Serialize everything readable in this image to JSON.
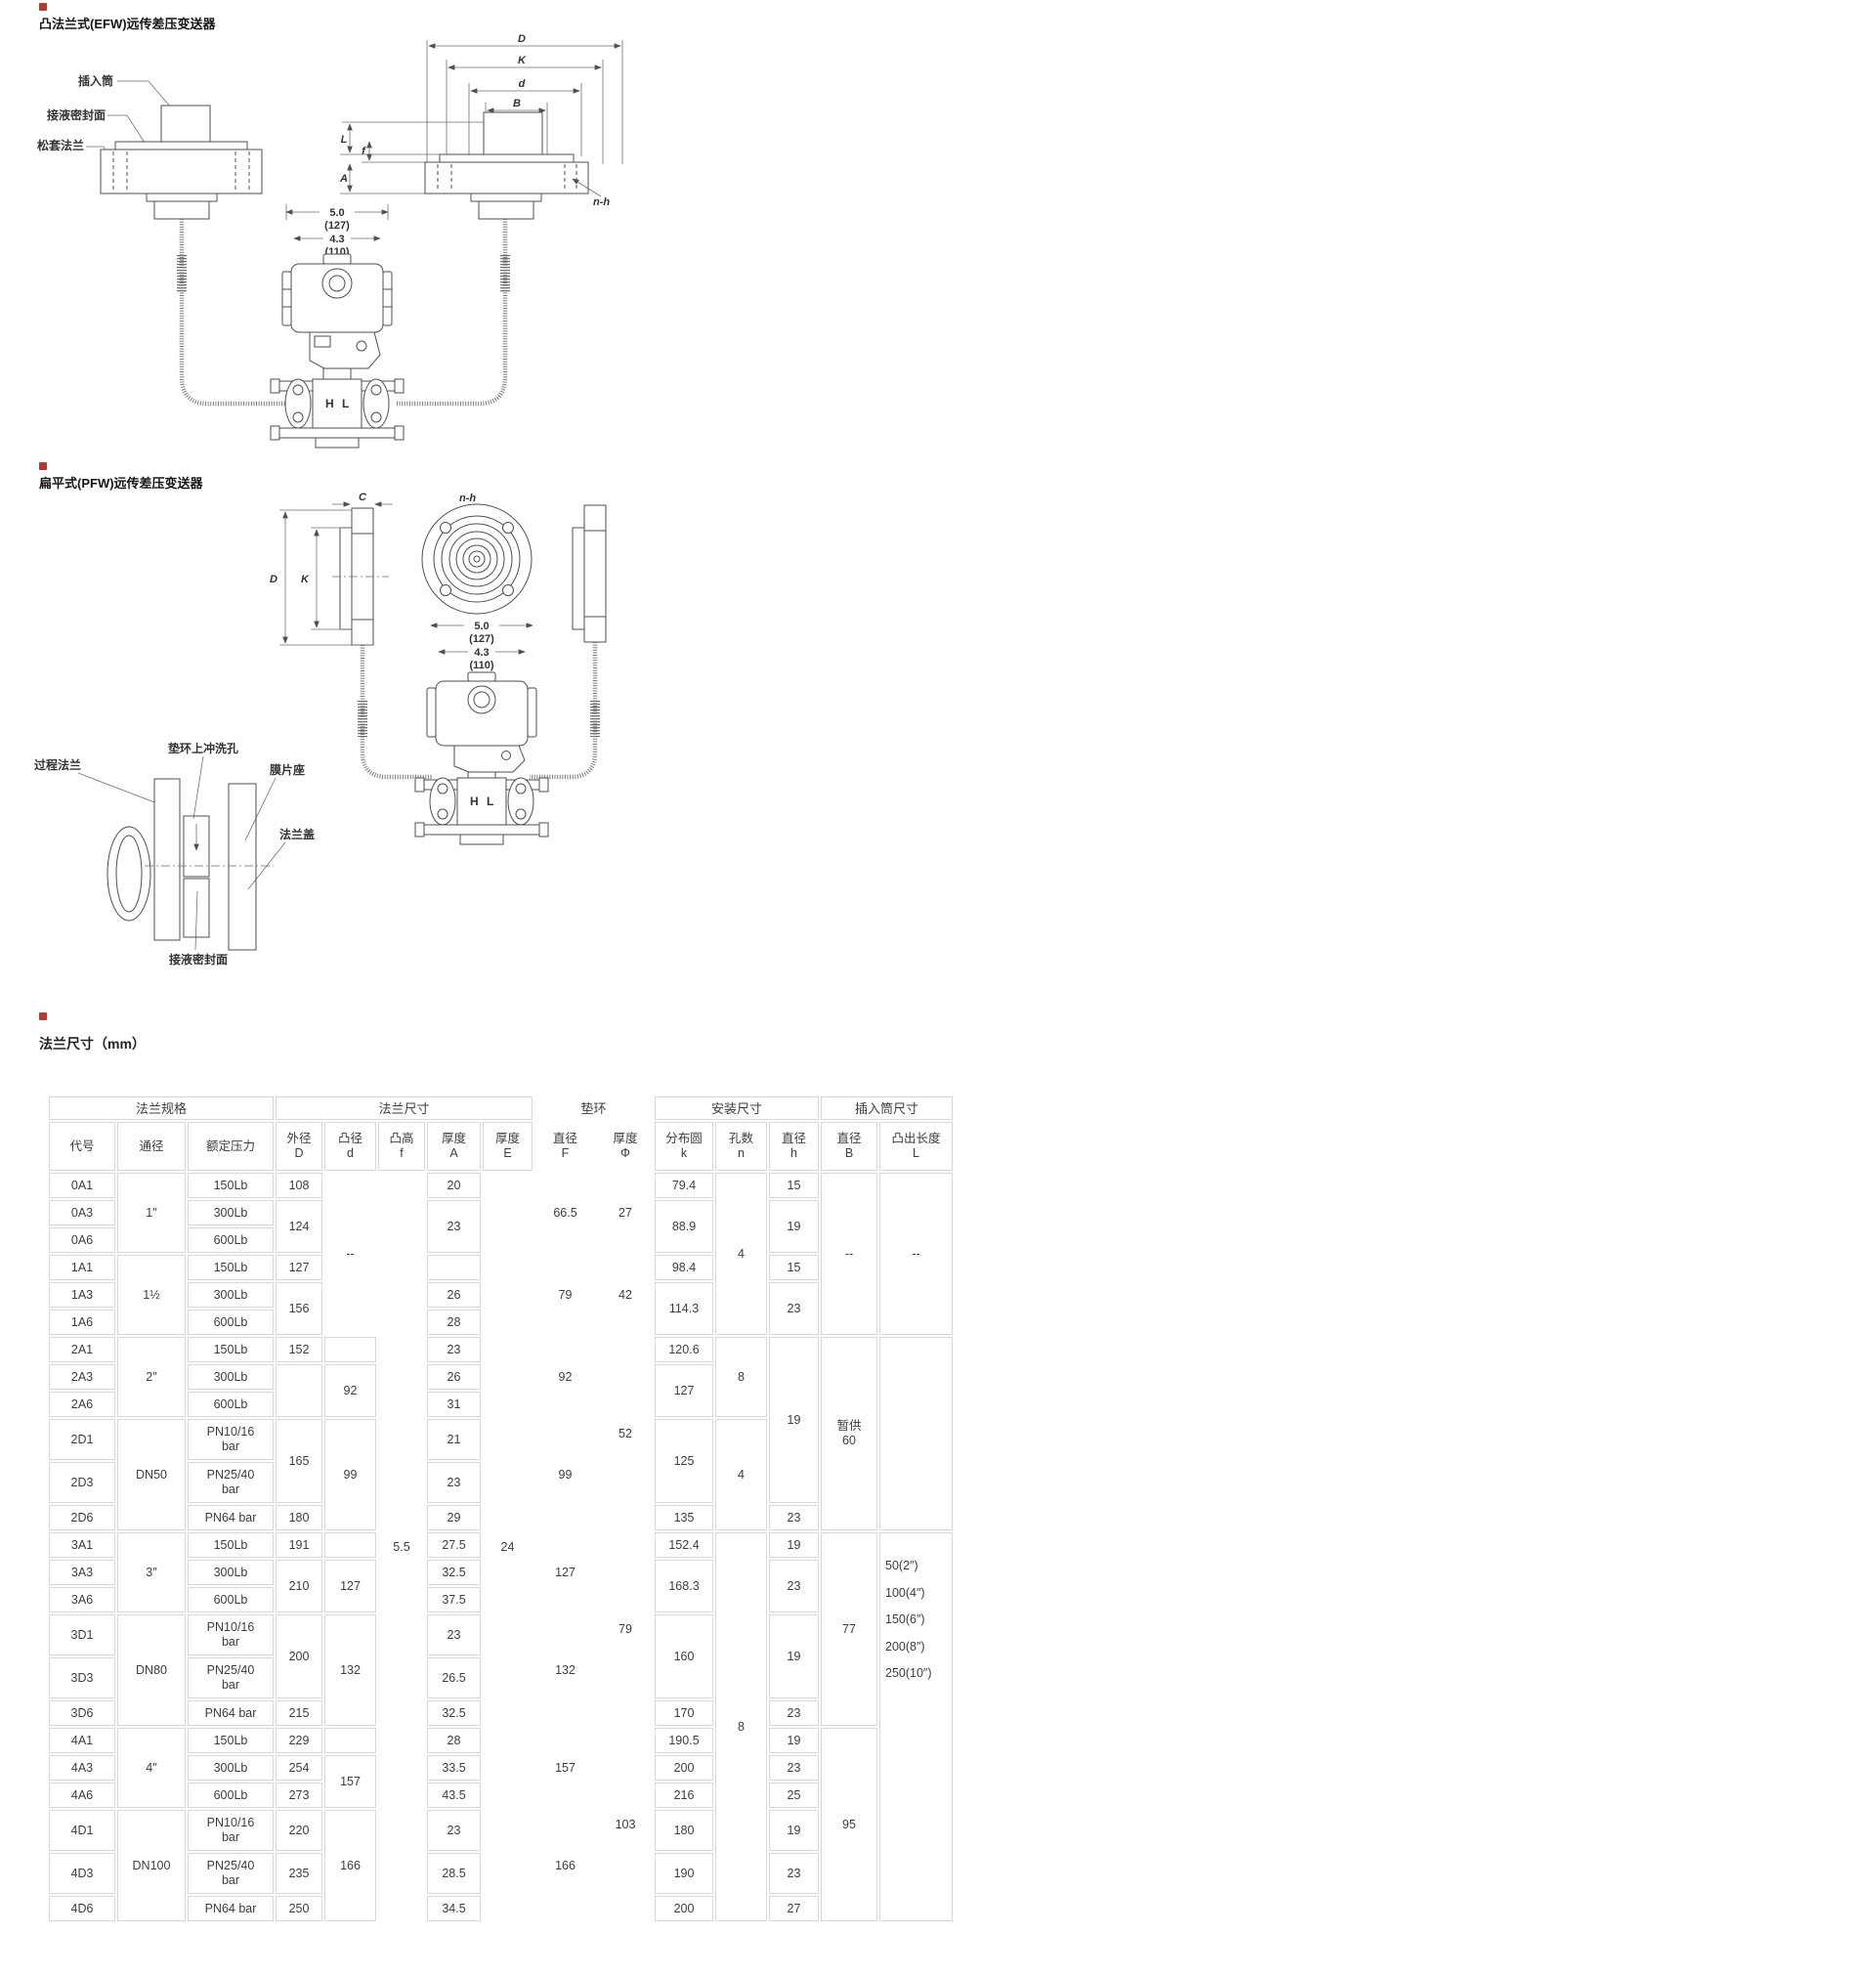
{
  "colors": {
    "bullet": "#b23b2e",
    "table_border": "#d8d8d8",
    "text": "#3d3d3d",
    "line": "#4f4f4f"
  },
  "efw": {
    "title": "凸法兰式(EFW)远传差压变送器",
    "labels": {
      "insert_tube": "插入筒",
      "wetted_seal_face": "接液密封面",
      "loose_flange": "松套法兰",
      "dim_D": "D",
      "dim_K": "K",
      "dim_d": "d",
      "dim_B": "B",
      "dim_L": "L",
      "dim_A": "A",
      "dim_f": "f",
      "n_h": "n-h",
      "width_in": "5.0",
      "width_mm": "(127)",
      "width2_in": "4.3",
      "width2_mm": "(110)",
      "port_H": "H",
      "port_L": "L"
    }
  },
  "pfw": {
    "title": "扁平式(PFW)远传差压变送器",
    "labels": {
      "process_flange": "过程法兰",
      "flush_hole": "垫环上冲洗孔",
      "diaphragm_seat": "膜片座",
      "flange_cover": "法兰盖",
      "wetted_seal_face": "接液密封面",
      "dim_C": "C",
      "dim_D": "D",
      "dim_K": "K",
      "n_h": "n-h",
      "width_in": "5.0",
      "width_mm": "(127)",
      "width2_in": "4.3",
      "width2_mm": "(110)",
      "port_H": "H",
      "port_L": "L"
    }
  },
  "table": {
    "title": "法兰尺寸（mm）",
    "groups": [
      {
        "label": "法兰规格",
        "span": 3,
        "bordered": true
      },
      {
        "label": "法兰尺寸",
        "span": 5,
        "bordered": true
      },
      {
        "label": "垫环",
        "span": 2,
        "bordered": false
      },
      {
        "label": "安装尺寸",
        "span": 3,
        "bordered": true
      },
      {
        "label": "插入筒尺寸",
        "span": 2,
        "bordered": true
      }
    ],
    "columns": [
      {
        "label": "代号",
        "width": 68
      },
      {
        "label": "通径",
        "width": 70
      },
      {
        "label": "额定压力",
        "width": 88
      },
      {
        "label": "外径\nD",
        "width": 48
      },
      {
        "label": "凸径\nd",
        "width": 53
      },
      {
        "label": "凸高\nf",
        "width": 48
      },
      {
        "label": "厚度\nA",
        "width": 55
      },
      {
        "label": "厚度\nE",
        "width": 51
      },
      {
        "label": "直径\nF",
        "width": 63,
        "borderless": true
      },
      {
        "label": "厚度\nΦ",
        "width": 56,
        "borderless": true
      },
      {
        "label": "分布圆\nk",
        "width": 60
      },
      {
        "label": "孔数\nn",
        "width": 53
      },
      {
        "label": "直径\nh",
        "width": 51
      },
      {
        "label": "直径\nB",
        "width": 58
      },
      {
        "label": "凸出长度\nL",
        "width": 75
      }
    ],
    "rows": [
      {
        "cells": [
          {
            "t": "0A1"
          },
          {
            "t": "1″",
            "rs": 3
          },
          {
            "t": "150Lb"
          },
          {
            "t": "108"
          },
          {
            "t": "--",
            "rs": 6,
            "nb": true
          },
          {
            "t": "5.5",
            "rs": 24,
            "nb": true
          },
          {
            "t": "20"
          },
          {
            "t": "24",
            "rs": 24,
            "nb": true
          },
          {
            "t": "66.5",
            "rs": 3,
            "nb": true
          },
          {
            "t": "27",
            "rs": 3,
            "nb": true
          },
          {
            "t": "79.4"
          },
          {
            "t": "4",
            "rs": 6
          },
          {
            "t": "15"
          },
          {
            "t": "--",
            "rs": 6
          },
          {
            "t": "--",
            "rs": 6
          }
        ]
      },
      {
        "cells": [
          {
            "t": "0A3"
          },
          {
            "t": "300Lb"
          },
          {
            "t": "124",
            "rs": 2
          },
          {
            "t": "23",
            "rs": 2
          },
          {
            "t": "88.9",
            "rs": 2
          },
          {
            "t": "19",
            "rs": 2
          }
        ]
      },
      {
        "cells": [
          {
            "t": "0A6"
          },
          {
            "t": "600Lb"
          }
        ]
      },
      {
        "cells": [
          {
            "t": "1A1"
          },
          {
            "t": "1½",
            "rs": 3
          },
          {
            "t": "150Lb"
          },
          {
            "t": "127"
          },
          {
            "t": ""
          },
          {
            "t": "79",
            "rs": 3,
            "nb": true
          },
          {
            "t": "42",
            "rs": 3,
            "nb": true
          },
          {
            "t": "98.4"
          },
          {
            "t": "15"
          }
        ]
      },
      {
        "cells": [
          {
            "t": "1A3"
          },
          {
            "t": "300Lb"
          },
          {
            "t": "156",
            "rs": 2
          },
          {
            "t": "26"
          },
          {
            "t": "114.3",
            "rs": 2
          },
          {
            "t": "23",
            "rs": 2
          }
        ]
      },
      {
        "cells": [
          {
            "t": "1A6"
          },
          {
            "t": "600Lb"
          },
          {
            "t": "28"
          }
        ]
      },
      {
        "cells": [
          {
            "t": "2A1"
          },
          {
            "t": "2″",
            "rs": 3
          },
          {
            "t": "150Lb"
          },
          {
            "t": "152"
          },
          {
            "t": ""
          },
          {
            "t": "23"
          },
          {
            "t": "92",
            "rs": 3,
            "nb": true
          },
          {
            "t": "52",
            "rs": 6,
            "nb": true
          },
          {
            "t": "120.6"
          },
          {
            "t": "8",
            "rs": 3
          },
          {
            "t": "19",
            "rs": 5
          },
          {
            "t": "暂供\n60",
            "rs": 6
          },
          {
            "t": "",
            "rs": 6
          }
        ]
      },
      {
        "cells": [
          {
            "t": "2A3"
          },
          {
            "t": "300Lb"
          },
          {
            "t": "",
            "rs": 2
          },
          {
            "t": "92",
            "rs": 2
          },
          {
            "t": "26"
          },
          {
            "t": "127",
            "rs": 2
          }
        ]
      },
      {
        "cells": [
          {
            "t": "2A6"
          },
          {
            "t": "600Lb"
          },
          {
            "t": "31"
          }
        ]
      },
      {
        "tall": true,
        "cells": [
          {
            "t": "2D1"
          },
          {
            "t": "DN50",
            "rs": 3
          },
          {
            "t": "PN10/16\nbar"
          },
          {
            "t": "165",
            "rs": 2
          },
          {
            "t": "99",
            "rs": 3
          },
          {
            "t": "21"
          },
          {
            "t": "99",
            "rs": 3,
            "nb": true
          },
          {
            "t": "125",
            "rs": 2
          },
          {
            "t": "4",
            "rs": 3
          }
        ]
      },
      {
        "tall": true,
        "cells": [
          {
            "t": "2D3"
          },
          {
            "t": "PN25/40\nbar"
          },
          {
            "t": "23"
          }
        ]
      },
      {
        "cells": [
          {
            "t": "2D6"
          },
          {
            "t": "PN64 bar"
          },
          {
            "t": "180"
          },
          {
            "t": "29"
          },
          {
            "t": "135"
          },
          {
            "t": "23"
          }
        ]
      },
      {
        "cells": [
          {
            "t": "3A1"
          },
          {
            "t": "3″",
            "rs": 3
          },
          {
            "t": "150Lb"
          },
          {
            "t": "191"
          },
          {
            "t": ""
          },
          {
            "t": "27.5"
          },
          {
            "t": "127",
            "rs": 3,
            "nb": true
          },
          {
            "t": "79",
            "rs": 6,
            "nb": true
          },
          {
            "t": "152.4"
          },
          {
            "t": "8",
            "rs": 12
          },
          {
            "t": "19"
          },
          {
            "t": "77",
            "rs": 6
          },
          {
            "t": "50(2″)\n100(4″)\n150(6″)\n200(8″)\n250(10″)",
            "rs": 12,
            "cls": "l-list"
          }
        ]
      },
      {
        "cells": [
          {
            "t": "3A3"
          },
          {
            "t": "300Lb"
          },
          {
            "t": "210",
            "rs": 2
          },
          {
            "t": "127",
            "rs": 2
          },
          {
            "t": "32.5"
          },
          {
            "t": "168.3",
            "rs": 2
          },
          {
            "t": "23",
            "rs": 2
          }
        ]
      },
      {
        "cells": [
          {
            "t": "3A6"
          },
          {
            "t": "600Lb"
          },
          {
            "t": "37.5"
          }
        ]
      },
      {
        "tall": true,
        "cells": [
          {
            "t": "3D1"
          },
          {
            "t": "DN80",
            "rs": 3
          },
          {
            "t": "PN10/16\nbar"
          },
          {
            "t": "200",
            "rs": 2
          },
          {
            "t": "132",
            "rs": 3
          },
          {
            "t": "23"
          },
          {
            "t": "132",
            "rs": 3,
            "nb": true
          },
          {
            "t": "160",
            "rs": 2
          },
          {
            "t": "19",
            "rs": 2
          }
        ]
      },
      {
        "tall": true,
        "cells": [
          {
            "t": "3D3"
          },
          {
            "t": "PN25/40\nbar"
          },
          {
            "t": "26.5"
          }
        ]
      },
      {
        "cells": [
          {
            "t": "3D6"
          },
          {
            "t": "PN64 bar"
          },
          {
            "t": "215"
          },
          {
            "t": "32.5"
          },
          {
            "t": "170"
          },
          {
            "t": "23"
          }
        ]
      },
      {
        "cells": [
          {
            "t": "4A1"
          },
          {
            "t": "4″",
            "rs": 3
          },
          {
            "t": "150Lb"
          },
          {
            "t": "229"
          },
          {
            "t": ""
          },
          {
            "t": "28"
          },
          {
            "t": "157",
            "rs": 3,
            "nb": true
          },
          {
            "t": "103",
            "rs": 6,
            "nb": true
          },
          {
            "t": "190.5"
          },
          {
            "t": "19"
          },
          {
            "t": "95",
            "rs": 6
          }
        ]
      },
      {
        "cells": [
          {
            "t": "4A3"
          },
          {
            "t": "300Lb"
          },
          {
            "t": "254"
          },
          {
            "t": "157",
            "rs": 2
          },
          {
            "t": "33.5"
          },
          {
            "t": "200"
          },
          {
            "t": "23"
          }
        ]
      },
      {
        "cells": [
          {
            "t": "4A6"
          },
          {
            "t": "600Lb"
          },
          {
            "t": "273"
          },
          {
            "t": "43.5"
          },
          {
            "t": "216"
          },
          {
            "t": "25"
          }
        ]
      },
      {
        "tall": true,
        "cells": [
          {
            "t": "4D1"
          },
          {
            "t": "DN100",
            "rs": 3
          },
          {
            "t": "PN10/16\nbar"
          },
          {
            "t": "220"
          },
          {
            "t": "166",
            "rs": 3
          },
          {
            "t": "23"
          },
          {
            "t": "166",
            "rs": 3,
            "nb": true
          },
          {
            "t": "180"
          },
          {
            "t": "19"
          }
        ]
      },
      {
        "tall": true,
        "cells": [
          {
            "t": "4D3"
          },
          {
            "t": "PN25/40\nbar"
          },
          {
            "t": "235"
          },
          {
            "t": "28.5"
          },
          {
            "t": "190"
          },
          {
            "t": "23"
          }
        ]
      },
      {
        "cells": [
          {
            "t": "4D6"
          },
          {
            "t": "PN64 bar"
          },
          {
            "t": "250"
          },
          {
            "t": "34.5"
          },
          {
            "t": "200"
          },
          {
            "t": "27"
          }
        ]
      }
    ]
  }
}
